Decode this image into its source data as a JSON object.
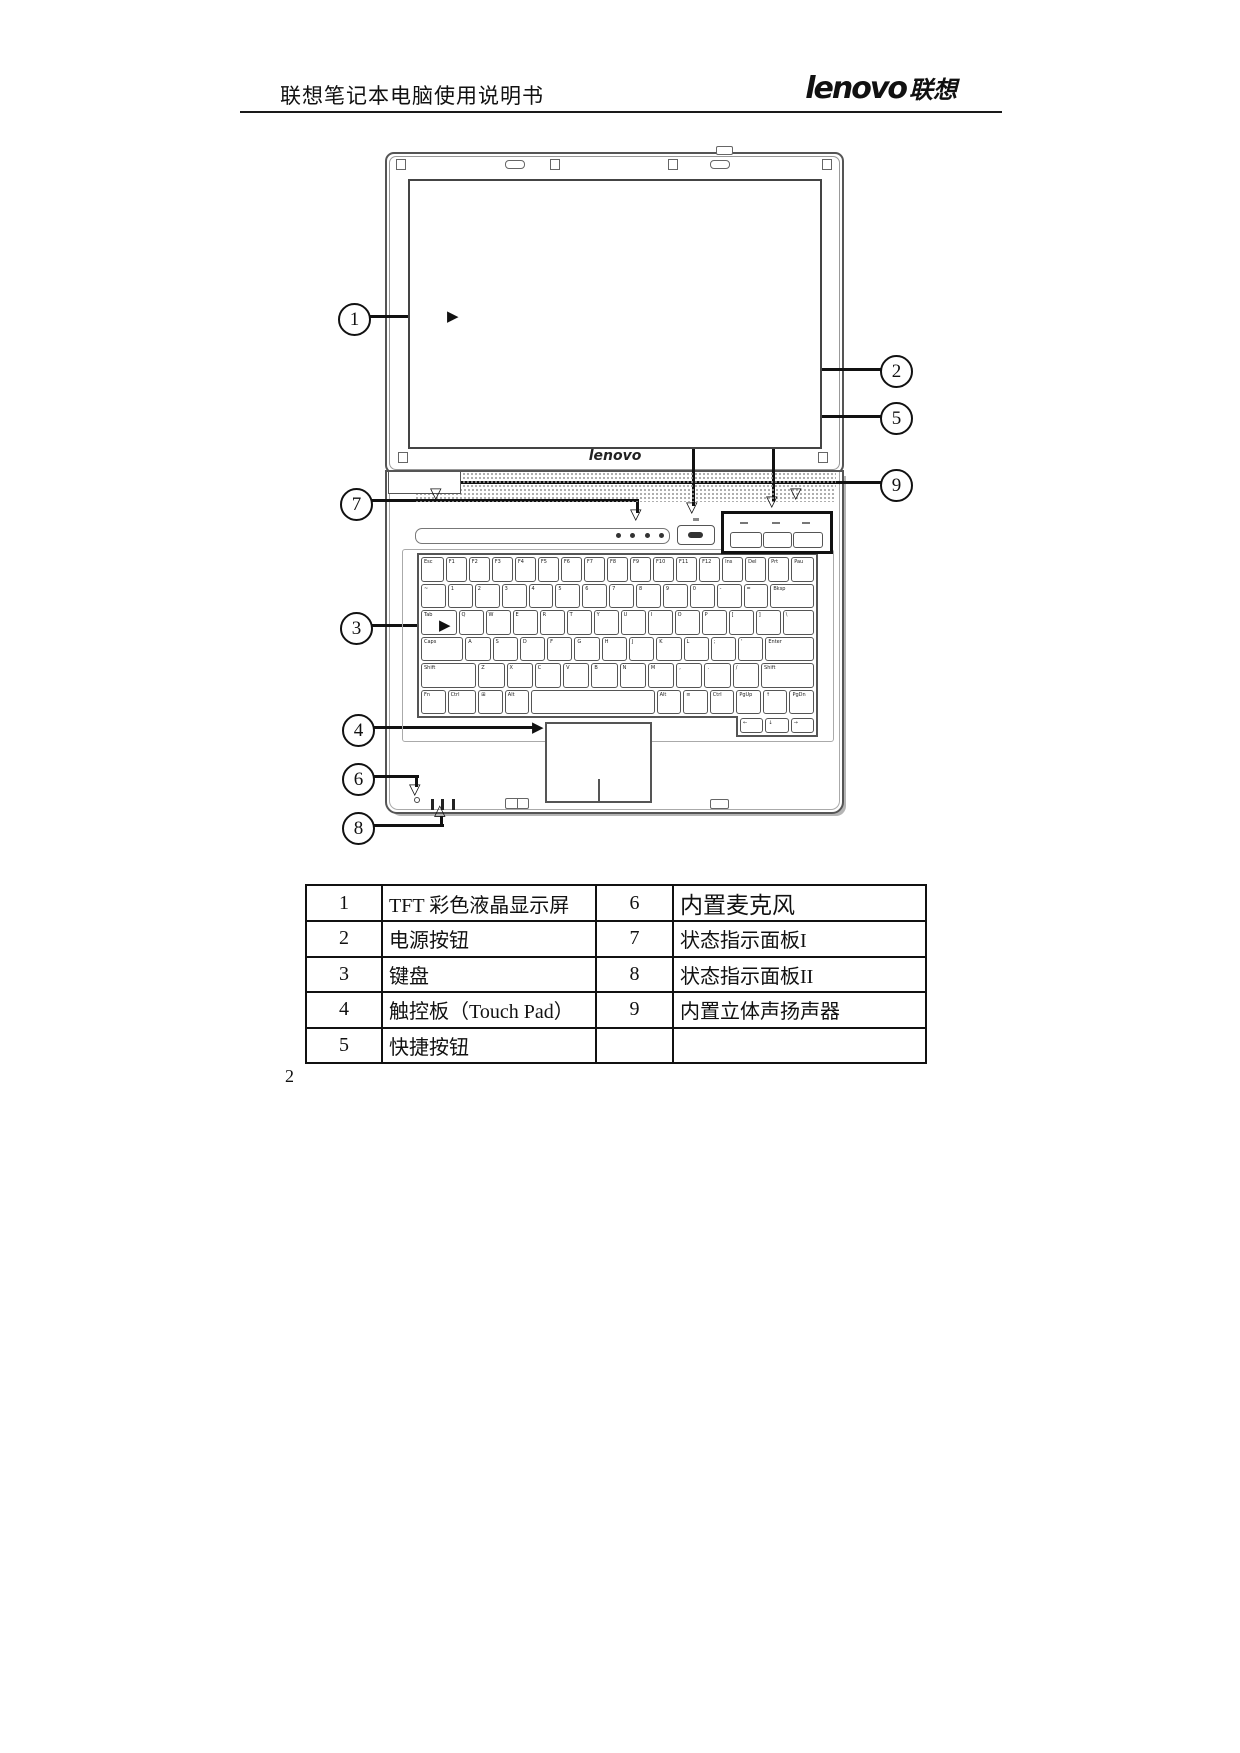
{
  "header": {
    "doc_title": "联想笔记本电脑使用说明书",
    "logo_main": "lenovo",
    "logo_cn": "联想"
  },
  "diagram": {
    "lid_logo": "lenovo"
  },
  "glyphs": {
    "arrow_right": "▶",
    "arrow_down": "▽",
    "arrow_up": "△"
  },
  "callouts": [
    "1",
    "2",
    "3",
    "4",
    "5",
    "6",
    "7",
    "8",
    "9"
  ],
  "keyboard": {
    "rows": [
      [
        {
          "l": "Esc",
          "w": 1.1
        },
        {
          "l": "F1"
        },
        {
          "l": "F2"
        },
        {
          "l": "F3"
        },
        {
          "l": "F4"
        },
        {
          "l": "F5"
        },
        {
          "l": "F6"
        },
        {
          "l": "F7"
        },
        {
          "l": "F8"
        },
        {
          "l": "F9"
        },
        {
          "l": "F10"
        },
        {
          "l": "F11"
        },
        {
          "l": "F12"
        },
        {
          "l": "Ins"
        },
        {
          "l": "Del"
        },
        {
          "l": "Prt"
        },
        {
          "l": "Pau",
          "w": 1.1
        }
      ],
      [
        {
          "l": "~"
        },
        {
          "l": "1"
        },
        {
          "l": "2"
        },
        {
          "l": "3"
        },
        {
          "l": "4"
        },
        {
          "l": "5"
        },
        {
          "l": "6"
        },
        {
          "l": "7"
        },
        {
          "l": "8"
        },
        {
          "l": "9"
        },
        {
          "l": "0"
        },
        {
          "l": "-"
        },
        {
          "l": "="
        },
        {
          "l": "Bksp",
          "w": 1.9
        }
      ],
      [
        {
          "l": "Tab",
          "w": 1.5
        },
        {
          "l": "Q"
        },
        {
          "l": "W"
        },
        {
          "l": "E"
        },
        {
          "l": "R"
        },
        {
          "l": "T"
        },
        {
          "l": "Y"
        },
        {
          "l": "U"
        },
        {
          "l": "I"
        },
        {
          "l": "O"
        },
        {
          "l": "P"
        },
        {
          "l": "["
        },
        {
          "l": "]"
        },
        {
          "l": "\\",
          "w": 1.3
        }
      ],
      [
        {
          "l": "Caps",
          "w": 1.8
        },
        {
          "l": "A"
        },
        {
          "l": "S"
        },
        {
          "l": "D"
        },
        {
          "l": "F"
        },
        {
          "l": "G"
        },
        {
          "l": "H"
        },
        {
          "l": "J"
        },
        {
          "l": "K"
        },
        {
          "l": "L"
        },
        {
          "l": ";"
        },
        {
          "l": "'"
        },
        {
          "l": "Enter",
          "w": 2.1
        }
      ],
      [
        {
          "l": "Shift",
          "w": 2.3
        },
        {
          "l": "Z"
        },
        {
          "l": "X"
        },
        {
          "l": "C"
        },
        {
          "l": "V"
        },
        {
          "l": "B"
        },
        {
          "l": "N"
        },
        {
          "l": "M"
        },
        {
          "l": ","
        },
        {
          "l": "."
        },
        {
          "l": "/"
        },
        {
          "l": "Shift",
          "w": 2.2
        }
      ],
      [
        {
          "l": "Fn"
        },
        {
          "l": "Ctrl",
          "w": 1.2
        },
        {
          "l": "⊞"
        },
        {
          "l": "Alt"
        },
        {
          "l": "",
          "w": 5.8
        },
        {
          "l": "Alt"
        },
        {
          "l": "≡"
        },
        {
          "l": "Ctrl"
        },
        {
          "l": "PgUp"
        },
        {
          "l": "↑"
        },
        {
          "l": "PgDn"
        }
      ]
    ],
    "overhang": [
      {
        "l": "←"
      },
      {
        "l": "↓"
      },
      {
        "l": "→"
      }
    ]
  },
  "table": {
    "rows": [
      [
        "1",
        "TFT 彩色液晶显示屏",
        "6",
        "内置麦克风"
      ],
      [
        "2",
        "电源按钮",
        "7",
        "状态指示面板I"
      ],
      [
        "3",
        "键盘",
        "8",
        "状态指示面板II"
      ],
      [
        "4",
        "触控板（Touch Pad）",
        "9",
        "内置立体声扬声器"
      ],
      [
        "5",
        "快捷按钮",
        "",
        ""
      ]
    ]
  },
  "footer": {
    "page_number": "2"
  }
}
